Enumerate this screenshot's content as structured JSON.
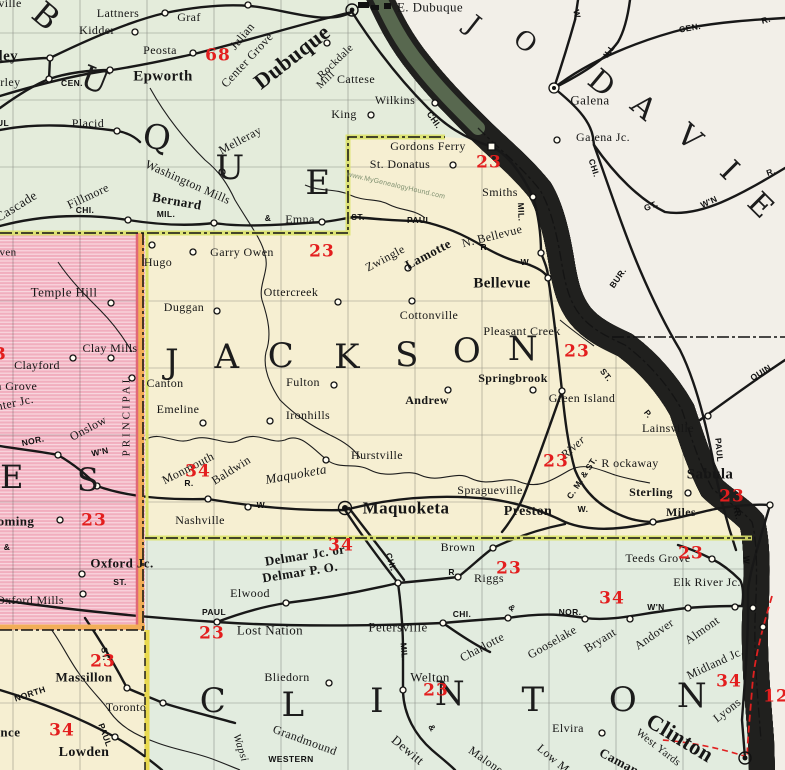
{
  "watermark": "www.MyGenealogyHound.com",
  "colors": {
    "jackson_fill": "#f6efd2",
    "dubuque_fill": "#e4ecdb",
    "clinton_fill": "#e2ecdf",
    "jones_fill": "#f1aebe",
    "cedar_fill": "#f6efd2",
    "illinois_fill": "#f2efe8",
    "river_yellow": "#e5d34f",
    "border_yellow_green": "#dce26a",
    "meridian_orange": "#f2ae57",
    "route_red": "#e31e1e"
  },
  "counties": {
    "jackson": {
      "l1": "J",
      "l2": "A",
      "l3": "C",
      "l4": "K",
      "l5": "S",
      "l6": "O",
      "l7": "N"
    },
    "clinton": {
      "l1": "C",
      "l2": "L",
      "l3": "I",
      "l4": "N",
      "l5": "T",
      "l6": "O",
      "l7": "N"
    },
    "dubuque": {
      "l1": "B",
      "l2": "U",
      "l3": "Q",
      "l4": "U",
      "l5": "E"
    },
    "jones": {
      "l1": "E",
      "l2": "S"
    },
    "jo_daviess": {
      "l1": "J",
      "l2": "O",
      "l3": "D",
      "l4": "A",
      "l5": "V",
      "l6": "I",
      "l7": "E"
    }
  },
  "towns": {
    "lattners": "Lattners",
    "kidder": "Kidder",
    "graf": "Graf",
    "peosta": "Peosta",
    "epworth": "Epworth",
    "farley1": "Farley",
    "farley2": "Farley",
    "placid": "Placid",
    "julian": "Julian",
    "center_grove": "Center Grove",
    "dubuque_city": "Dubuque",
    "e_dubuque": "E. Dubuque",
    "rockdale": "Rockdale",
    "rockdale_mill": "Mill",
    "cattese": "Cattese",
    "wilkins": "Wilkins",
    "king": "King",
    "melleray": "Melleray",
    "washington_mills": "Washington Mills",
    "bernard": "Bernard",
    "emna": "Emna",
    "fillmore": "Fillmore",
    "cascade": "Cascade",
    "ville_frag": "ville",
    "galena": "Galena",
    "galena_jc": "Galena Jc.",
    "gordons_ferry": "Gordons Ferry",
    "st_donatus": "St. Donatus",
    "smiths": "Smiths",
    "n_bellevue": "N. Bellevue",
    "bellevue": "Bellevue",
    "zwingle": "Zwingle",
    "lamotte": "Lamotte",
    "hugo": "Hugo",
    "garry_owen": "Garry Owen",
    "duggan": "Duggan",
    "ottercreek": "Ottercreek",
    "cottonville": "Cottonville",
    "pleasant_creek": "Pleasant Creek",
    "temple_hill": "Temple Hill",
    "clay_mills": "Clay Mills",
    "clayford": "Clayford",
    "scotch_grove": "Scotch Grove",
    "center_jc": "Center Jc.",
    "onslow": "Onslow",
    "ven_frag": "ven",
    "canton": "Canton",
    "emeline": "Emeline",
    "ironhills": "Ironhills",
    "fulton": "Fulton",
    "andrew": "Andrew",
    "springbrook": "Springbrook",
    "green_island": "Green Island",
    "lainsville": "Lainsville",
    "rockaway": "R ockaway",
    "sterling": "Sterling",
    "sabula": "Sabula",
    "miles": "Miles",
    "preston": "Preston",
    "spragueville": "Spragueville",
    "maquoketa": "Maquoketa",
    "hurstville": "Hurstville",
    "nashville": "Nashville",
    "monmouth": "Monmouth",
    "baldwin": "Baldwin",
    "wyoming": "Wyoming",
    "oxford_jc": "Oxford Jc.",
    "oxford_mills": "Oxford Mills",
    "elwood": "Elwood",
    "lost_nation": "Lost Nation",
    "delmar1": "Delmar Jc. or",
    "delmar2": "Delmar P. O.",
    "brown": "Brown",
    "riggs": "Riggs",
    "petersville": "Petersville",
    "charlotte": "Charlotte",
    "welton": "Welton",
    "bliedorn": "Bliedorn",
    "gooselake": "Gooselake",
    "bryant": "Bryant",
    "andover": "Andover",
    "almont": "Almont",
    "elk_river_jc": "Elk River Jc.",
    "teeds_grove": "Teeds Grove",
    "midland_jc": "Midland Jc.",
    "lyons": "Lyons",
    "clinton_city": "Clinton",
    "west_yards": "West Yards",
    "camanche": "Camanche",
    "low_moor": "Low Moor",
    "malone": "Malone",
    "dewitt": "Dewitt",
    "grandmound": "Grandmound",
    "elvira": "Elvira",
    "massillon": "Massillon",
    "toronto": "Toronto",
    "lowden": "Lowden",
    "clarence": "Clarence"
  },
  "rail": {
    "cen_farley": "CEN.",
    "paul_frag": "PAUL",
    "chi_fillmore": "CHI.",
    "mil_bernard": "MIL.",
    "amp_bernard": "&",
    "st_zwingle": "ST.",
    "paul_zwingle": "PAUL",
    "r_lamotte": "R.",
    "w_lamotte": "W.",
    "mil_river": "MIL.",
    "chi_river": "CHI.",
    "w_galena": "W.",
    "ill_galena": "ILL.",
    "cen_galena": "CEN.",
    "r_galena": "R.",
    "chi_gtw": "CHI.",
    "gt_gtw": "GT.",
    "wn_gtw": "W'N",
    "r_gtw": "R.",
    "bur": "BUR.",
    "quin": "QUIN.",
    "st_p1": "ST.",
    "st_p2": "P.",
    "paul_vert": "PAUL",
    "r_sabula": "R.",
    "cmst": "C. M. & ST.",
    "w_preston": "W.",
    "w_midland": "W.",
    "r_baldwin": "R.",
    "nor_jones": "NOR.",
    "wn_jones": "W'N",
    "principal": "PRINCIPAL",
    "st_oxford": "ST.",
    "amp_left": "&",
    "paul_lost": "PAUL",
    "chi_delmar": "CHI.",
    "r_delmar": "R.",
    "chi_petersville": "CHI.",
    "amp_charlotte": "&",
    "nor_clinton": "NOR.",
    "wn_clinton": "W'N",
    "mil_welton": "MIL.",
    "amp_dewitt": "&",
    "western": "WESTERN",
    "north_cedar": "NORTH",
    "paul_cedar": "PAUL",
    "st_cedar": "ST.",
    "w_teeds": "W",
    "r_teeds": "R."
  },
  "water": {
    "maquoketa_river": "Maquoketa",
    "river_word": "River",
    "wapsi": "Wapsi"
  },
  "routes": {
    "n68": "68",
    "n23_donatus": "23",
    "n23_garryowen": "23",
    "n23_pleasant": "23",
    "n23_river": "23",
    "n23_sabula": "23",
    "n34_monmouth": "34",
    "n23_wyoming": "23",
    "n34_delmar": "34",
    "n23_riggs": "23",
    "n23_teeds": "23",
    "n34_nor": "34",
    "n23_lost": "23",
    "n23_massillon": "23",
    "n23_welton": "23",
    "n34_midland": "34",
    "n34_lowden": "34",
    "n23_left": "23",
    "n12_right": "12"
  }
}
